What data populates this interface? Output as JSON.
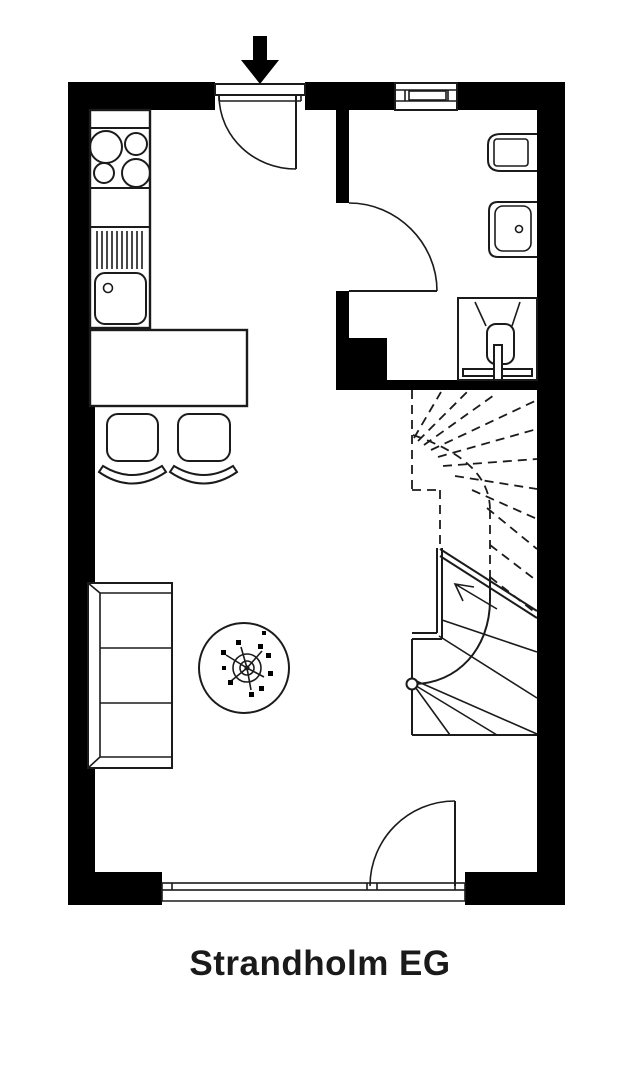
{
  "title": {
    "label": "Strandholm EG"
  },
  "colors": {
    "walls": "#000000",
    "lines": "#1b1b1b",
    "background": "#ffffff"
  },
  "fixtures": [
    "entrance-arrow-icon",
    "entrance-door",
    "kitchen-counter",
    "stove-icon",
    "drainer-icon",
    "sink-icon",
    "dining-table",
    "chair-icon",
    "sofa-icon",
    "round-table-icon",
    "plant-icon",
    "bathroom-window",
    "bathroom-door",
    "toilet-icon",
    "washbasin-icon",
    "shower-icon",
    "winder-staircase",
    "terrace-window-band",
    "terrace-door"
  ]
}
